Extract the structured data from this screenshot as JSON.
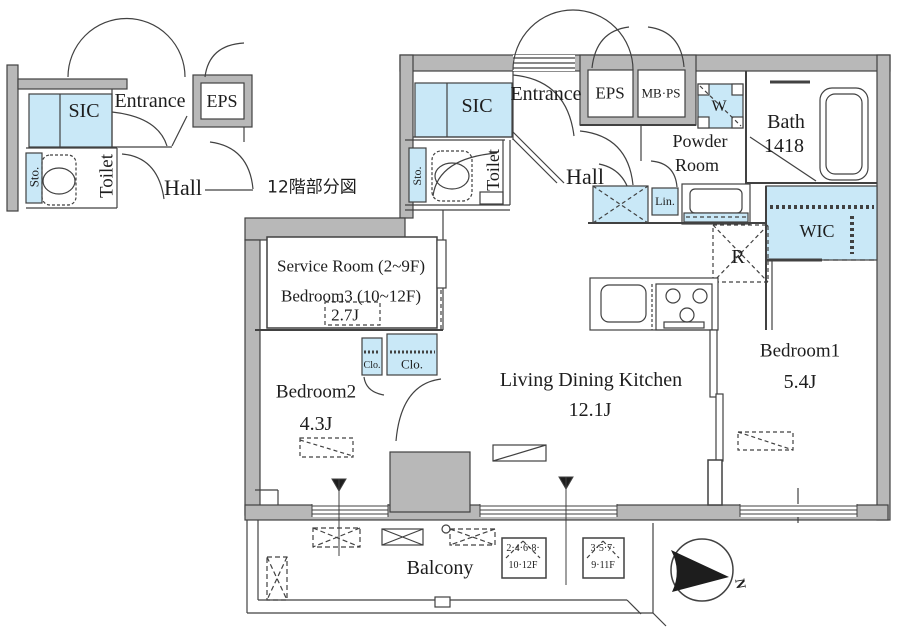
{
  "inset": {
    "caption": "12階部分図",
    "sic": "SIC",
    "entrance": "Entrance",
    "eps": "EPS",
    "sto": "Sto.",
    "toilet": "Toilet",
    "hall": "Hall"
  },
  "main": {
    "sic": "SIC",
    "entrance": "Entrance",
    "eps": "EPS",
    "mbps": "MB·PS",
    "washer": "W",
    "powder1": "Powder",
    "powder2": "Room",
    "bath1": "Bath",
    "bath2": "1418",
    "lin": "Lin.",
    "sto": "Sto.",
    "toilet": "Toilet",
    "hall": "Hall",
    "wic": "WIC",
    "fridge": "R",
    "service1": "Service Room (2~9F)",
    "service2": "Bedroom3 (10~12F)",
    "service_size": "2.7J",
    "bedroom2": "Bedroom2",
    "bedroom2_size": "4.3J",
    "clo_small": "Clo.",
    "clo_large": "Clo.",
    "ldk": "Living Dining Kitchen",
    "ldk_size": "12.1J",
    "bedroom1": "Bedroom1",
    "bedroom1_size": "5.4J",
    "balcony": "Balcony",
    "hatch1a": "2·4·6·8·",
    "hatch1b": "10·12F",
    "hatch2a": "3·5·7·",
    "hatch2b": "9·11F",
    "north": "N"
  },
  "colors": {
    "fixture_blue": "#c9e8f7",
    "wall_gray": "#b8b8b8",
    "line": "#414141"
  }
}
